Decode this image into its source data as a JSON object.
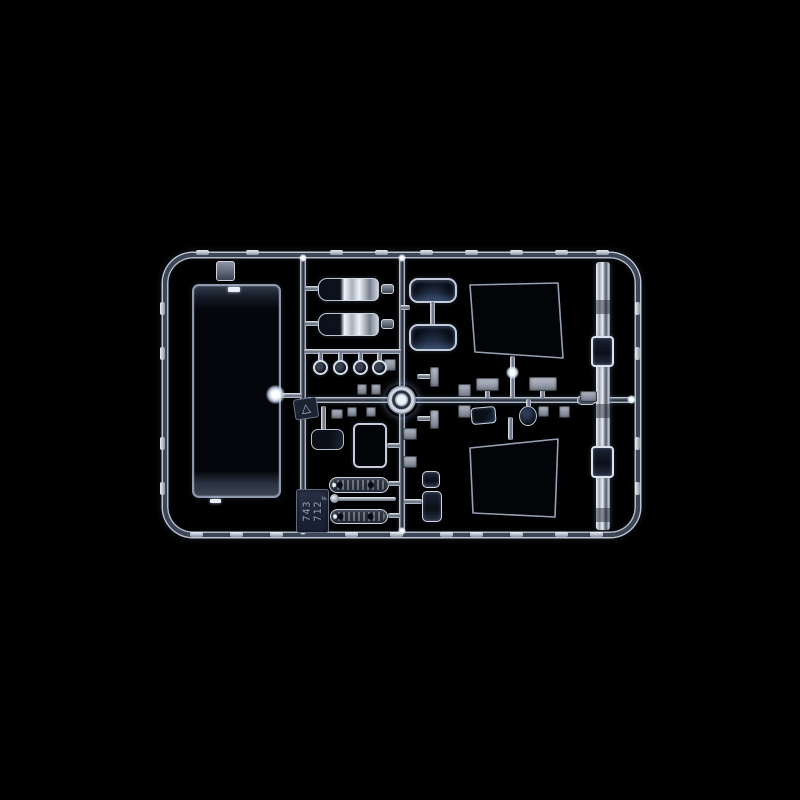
{
  "scene": {
    "subject": "Clear transparent plastic model-kit sprue (parts tree) with windshield, window panes, lenses and mirror parts, photographed on a black background",
    "background_color": "#000000",
    "plastic_edge_color": "#dfe6f2",
    "plastic_core_color": "#3a4250",
    "chrome_highlight_color": "#f2f5fa",
    "dark_glass_color": "#0a0f1a"
  },
  "sprue_tag": {
    "line1": "743",
    "line2": "712",
    "suffix": "F"
  },
  "icons": {
    "recycle_triangle": "△"
  }
}
